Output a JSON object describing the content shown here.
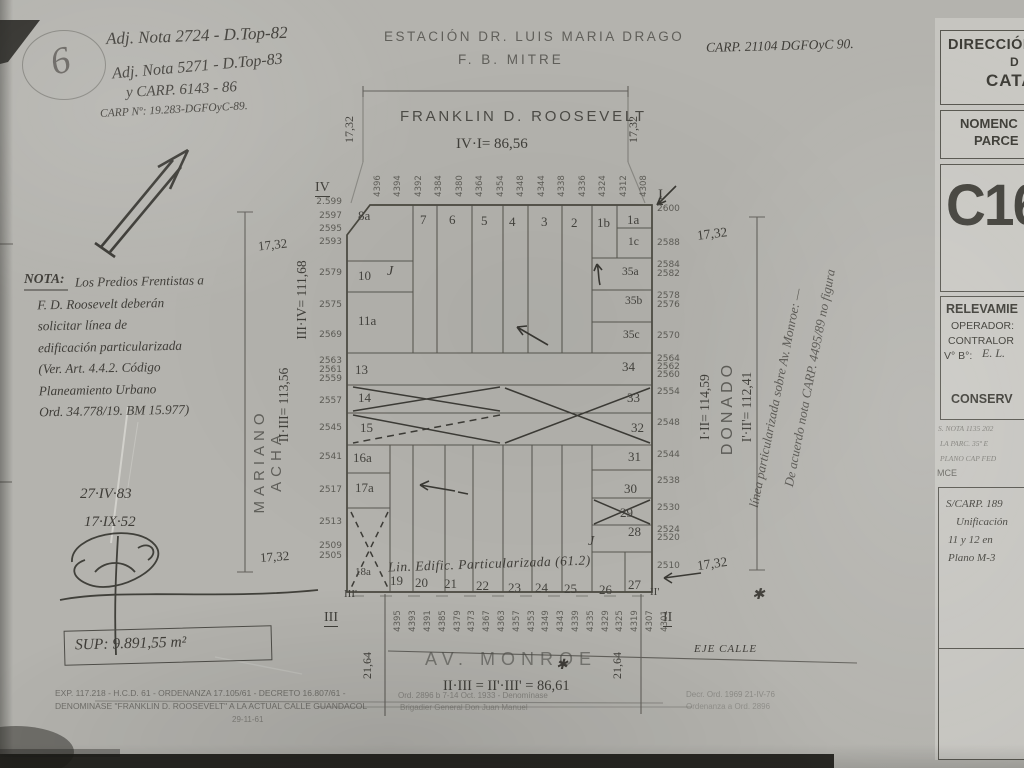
{
  "colors": {
    "paper": "#b4b3ae",
    "ink": "#3f3d38",
    "print": "#4c4b46",
    "panel_paper": "#c9c8c3",
    "line": "#54534d"
  },
  "header": {
    "sheet_circle": "6",
    "note1": "Adj. Nota 2724 - D.Top-82",
    "note2": "Adj. Nota 5271 - D.Top-83",
    "note3": "y CARP. 6143 - 86",
    "note4": "CARP Nº: 19.283-DGFOyC-89.",
    "station1": "ESTACIÓN DR. LUIS MARIA DRAGO",
    "station2": "F. B. MITRE",
    "carp_right": "CARP. 21104  DGFOyC 90."
  },
  "title_block": {
    "agency1": "DIRECCIÓN",
    "agency2": "D",
    "agency3": "CATA",
    "nomen1": "NOMENC",
    "nomen2": "PARCE",
    "code": "C16",
    "relev": "RELEVAMIE",
    "operador": "OPERADOR:",
    "contralor": "CONTRALOR",
    "vb": "V° B°:",
    "vb_value": "E. L.",
    "conserv": "CONSERV",
    "ref1": "S. NOTA 1135 202",
    "ref2": "LA PARC. 35ª E",
    "ref3": "PLANO CAP FED",
    "mce": "MCE",
    "carp1": "S/CARP. 189",
    "carp2": "Unificación",
    "carp3": "11 y 12 en",
    "carp4": "Plano M-3"
  },
  "streets": {
    "north": "FRANKLIN D. ROOSEVELT",
    "north_dim": "IV·I= 86,56",
    "west": "MARIANO ACHA",
    "west_dim_outer": "II·III= 113,56",
    "west_dim_inner": "III·IV= 111,68",
    "east": "DONADO",
    "east_dim_outer": "I·II= 114,59",
    "east_dim_inner": "I'·II'= 112,41",
    "south": "AV. MONROE",
    "south_dim": "II·III = II'·III' = 86,61",
    "axis": "EJE CALLE",
    "star": "✱"
  },
  "dims": {
    "w1": "17,32",
    "w2": "21,64"
  },
  "corners": {
    "ne": "I",
    "se": "II",
    "se_i": "II'",
    "sw": "III",
    "sw_i": "III'",
    "nw": "IV"
  },
  "parcels": {
    "top": [
      "8a",
      "7",
      "6",
      "5",
      "4",
      "3",
      "2",
      "1b",
      "1a"
    ],
    "c1": "1c",
    "c35": [
      "35a",
      "35b",
      "35c"
    ],
    "p10": "10",
    "p11": "11a",
    "p13": "13",
    "p14": "14",
    "p15": "15",
    "p16": "16a",
    "p17": "17a",
    "p18": "18a",
    "p34": "34",
    "p33": "33",
    "p32": "32",
    "p31": "31",
    "p30": "30",
    "p29": "29",
    "p28": "28",
    "bottom": [
      "19",
      "20",
      "21",
      "22",
      "23",
      "24",
      "25",
      "26",
      "27"
    ],
    "j": "J"
  },
  "addresses": {
    "top": [
      "4396",
      "4394",
      "4392",
      "4384",
      "4380",
      "4364",
      "4354",
      "4348",
      "4344",
      "4338",
      "4336",
      "4324",
      "4312",
      "4308"
    ],
    "bottom": [
      "4395",
      "4393",
      "4391",
      "4385",
      "4379",
      "4373",
      "4367",
      "4363",
      "4357",
      "4353",
      "4349",
      "4343",
      "4339",
      "4335",
      "4329",
      "4325",
      "4319",
      "4307",
      "4301"
    ],
    "west": [
      "2.599",
      "2597",
      "2595",
      "2593",
      "2579",
      "2575",
      "2569",
      "2563",
      "2561",
      "2559",
      "2557",
      "2545",
      "2541",
      "2517",
      "2513",
      "2509",
      "2505"
    ],
    "east": [
      "2600",
      "2588",
      "2584",
      "2582",
      "2578",
      "2576",
      "2570",
      "2564",
      "2562",
      "2560",
      "2554",
      "2548",
      "2544",
      "2538",
      "2530",
      "2524",
      "2520",
      "2510"
    ]
  },
  "annotations": {
    "lin_edific": "Lin. Edific. Particularizada (61.2)",
    "note_title": "NOTA:",
    "note_lines": [
      "Los Predios Frentistas a",
      "F. D. Roosevelt deberán",
      "solicitar línea de",
      "edificación particularizada",
      "(Ver. Art. 4.4.2. Código",
      "Planeamiento Urbano",
      "Ord. 34.778/19. BM 15.977)"
    ],
    "side1": "De acuerdo nota CARP. 4495/89 no figura",
    "side2": "línea particularizada sobre Av. Monroe: —",
    "star": "✱",
    "date1": "27·IV·83",
    "date2": "17·IX·52",
    "surface": "SUP: 9.891,55 m²"
  },
  "footer": {
    "l1": "EXP. 117.218 - H.C.D. 61 - ORDENANZA 17.105/61 - DECRETO 16.807/61 -",
    "l2": "DENOMINASE \"FRANKLIN D. ROOSEVELT\" A LA ACTUAL CALLE GUANDACOL",
    "l3": "29-11-61",
    "m1": "Ord. 2896 b 7-14 Oct. 1933 - Denomínase",
    "m2": "Brigadier General Don Juan Manuel",
    "r1": "Decr. Ord. 1969 21-IV-76",
    "r2": "Ordenanza a Ord. 2896"
  }
}
